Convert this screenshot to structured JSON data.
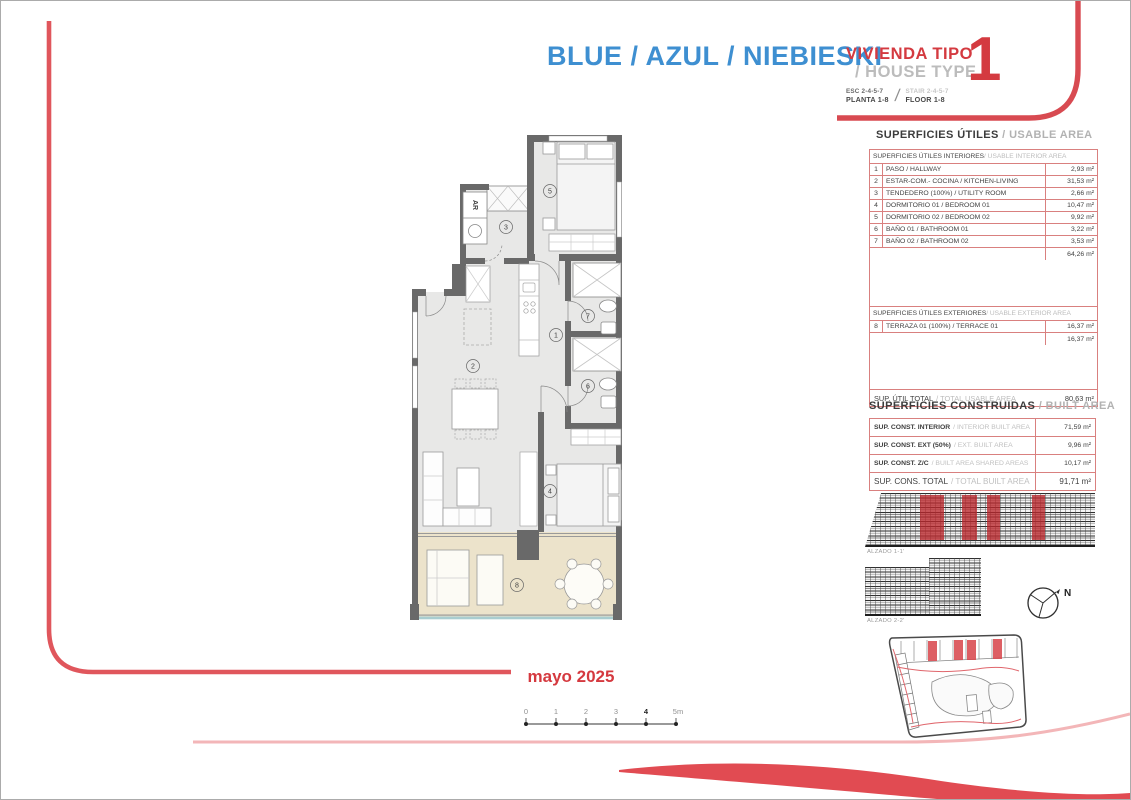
{
  "page": {
    "title": "BLUE / AZUL / NIEBIESKI",
    "vivienda_tipo": "VIVIENDA TIPO",
    "house_type": "/ HOUSE TYPE",
    "esc": "ESC 2-4-5-7",
    "planta": "PLANTA 1-8",
    "stair": "STAIR 2-4-5-7",
    "floor": "FLOOR 1-8",
    "separator": "/",
    "type_number": "1",
    "date": "mayo 2025"
  },
  "usable_area": {
    "title_es": "SUPERFICIES ÚTILES",
    "title_en": " / USABLE AREA",
    "interior": {
      "header_es": "SUPERFICIES ÚTILES INTERIORES",
      "header_en": " / USABLE INTERIOR AREA",
      "rows": [
        {
          "num": "1",
          "name": "PASO / HALLWAY",
          "value": "2,93 m²"
        },
        {
          "num": "2",
          "name": "ESTAR-COM.- COCINA / KITCHEN-LIVING",
          "value": "31,53 m²"
        },
        {
          "num": "3",
          "name": "TENDEDERO (100%) / UTILITY ROOM",
          "value": "2,66 m²"
        },
        {
          "num": "4",
          "name": "DORMITORIO 01 / BEDROOM 01",
          "value": "10,47 m²"
        },
        {
          "num": "5",
          "name": "DORMITORIO 02 / BEDROOM 02",
          "value": "9,92 m²"
        },
        {
          "num": "6",
          "name": "BAÑO 01 / BATHROOM 01",
          "value": "3,22 m²"
        },
        {
          "num": "7",
          "name": "BAÑO 02 / BATHROOM 02",
          "value": "3,53 m²"
        }
      ],
      "total": "64,26 m²"
    },
    "exterior": {
      "header_es": "SUPERFICIES ÚTILES EXTERIORES",
      "header_en": " / USABLE EXTERIOR AREA",
      "rows": [
        {
          "num": "8",
          "name": "TERRAZA 01 (100%) / TERRACE 01",
          "value": "16,37 m²"
        }
      ],
      "total": "16,37 m²"
    },
    "total_label_es": "SUP. ÚTIL TOTAL",
    "total_label_en": "/ TOTAL USABLE AREA",
    "total_value": "80,63 m²"
  },
  "built_area": {
    "title_es": "SUPERFICIES CONSTRUIDAS",
    "title_en": " / BUILT AREA",
    "rows": [
      {
        "label_es": "SUP. CONST. INTERIOR",
        "label_en": "/ INTERIOR BUILT AREA",
        "value": "71,59 m²"
      },
      {
        "label_es": "SUP. CONST. EXT (50%)",
        "label_en": "/ EXT. BUILT AREA",
        "value": "9,96 m²"
      },
      {
        "label_es": "SUP. CONST. Z/C",
        "label_en": "/ BUILT AREA SHARED AREAS",
        "value": "10,17 m²"
      }
    ],
    "total_label_es": "SUP. CONS. TOTAL",
    "total_label_en": "/ TOTAL BUILT AREA",
    "total_value": "91,71 m²"
  },
  "elevations": {
    "alzado_1": "ALZADO 1-1'",
    "alzado_2": "ALZADO 2-2'"
  },
  "compass": {
    "north": "N"
  },
  "floor_plan": {
    "room_numbers": [
      "1",
      "2",
      "3",
      "4",
      "5",
      "6",
      "7",
      "8"
    ],
    "washer_label": "AR"
  },
  "scale_bar": {
    "labels": [
      "0",
      "1",
      "2",
      "3",
      "4",
      "5m"
    ]
  },
  "colors": {
    "accent_blue": "#3e8fd1",
    "accent_red": "#d43a40",
    "swoosh_red": "#e0565c",
    "pale_red": "#f3b6b8",
    "muted_gray": "#b5b5b5",
    "table_border": "#d9807f",
    "terrace_floor": "#ece3cb",
    "interior_floor": "#e8e8e7",
    "wall_gray": "#696969"
  }
}
